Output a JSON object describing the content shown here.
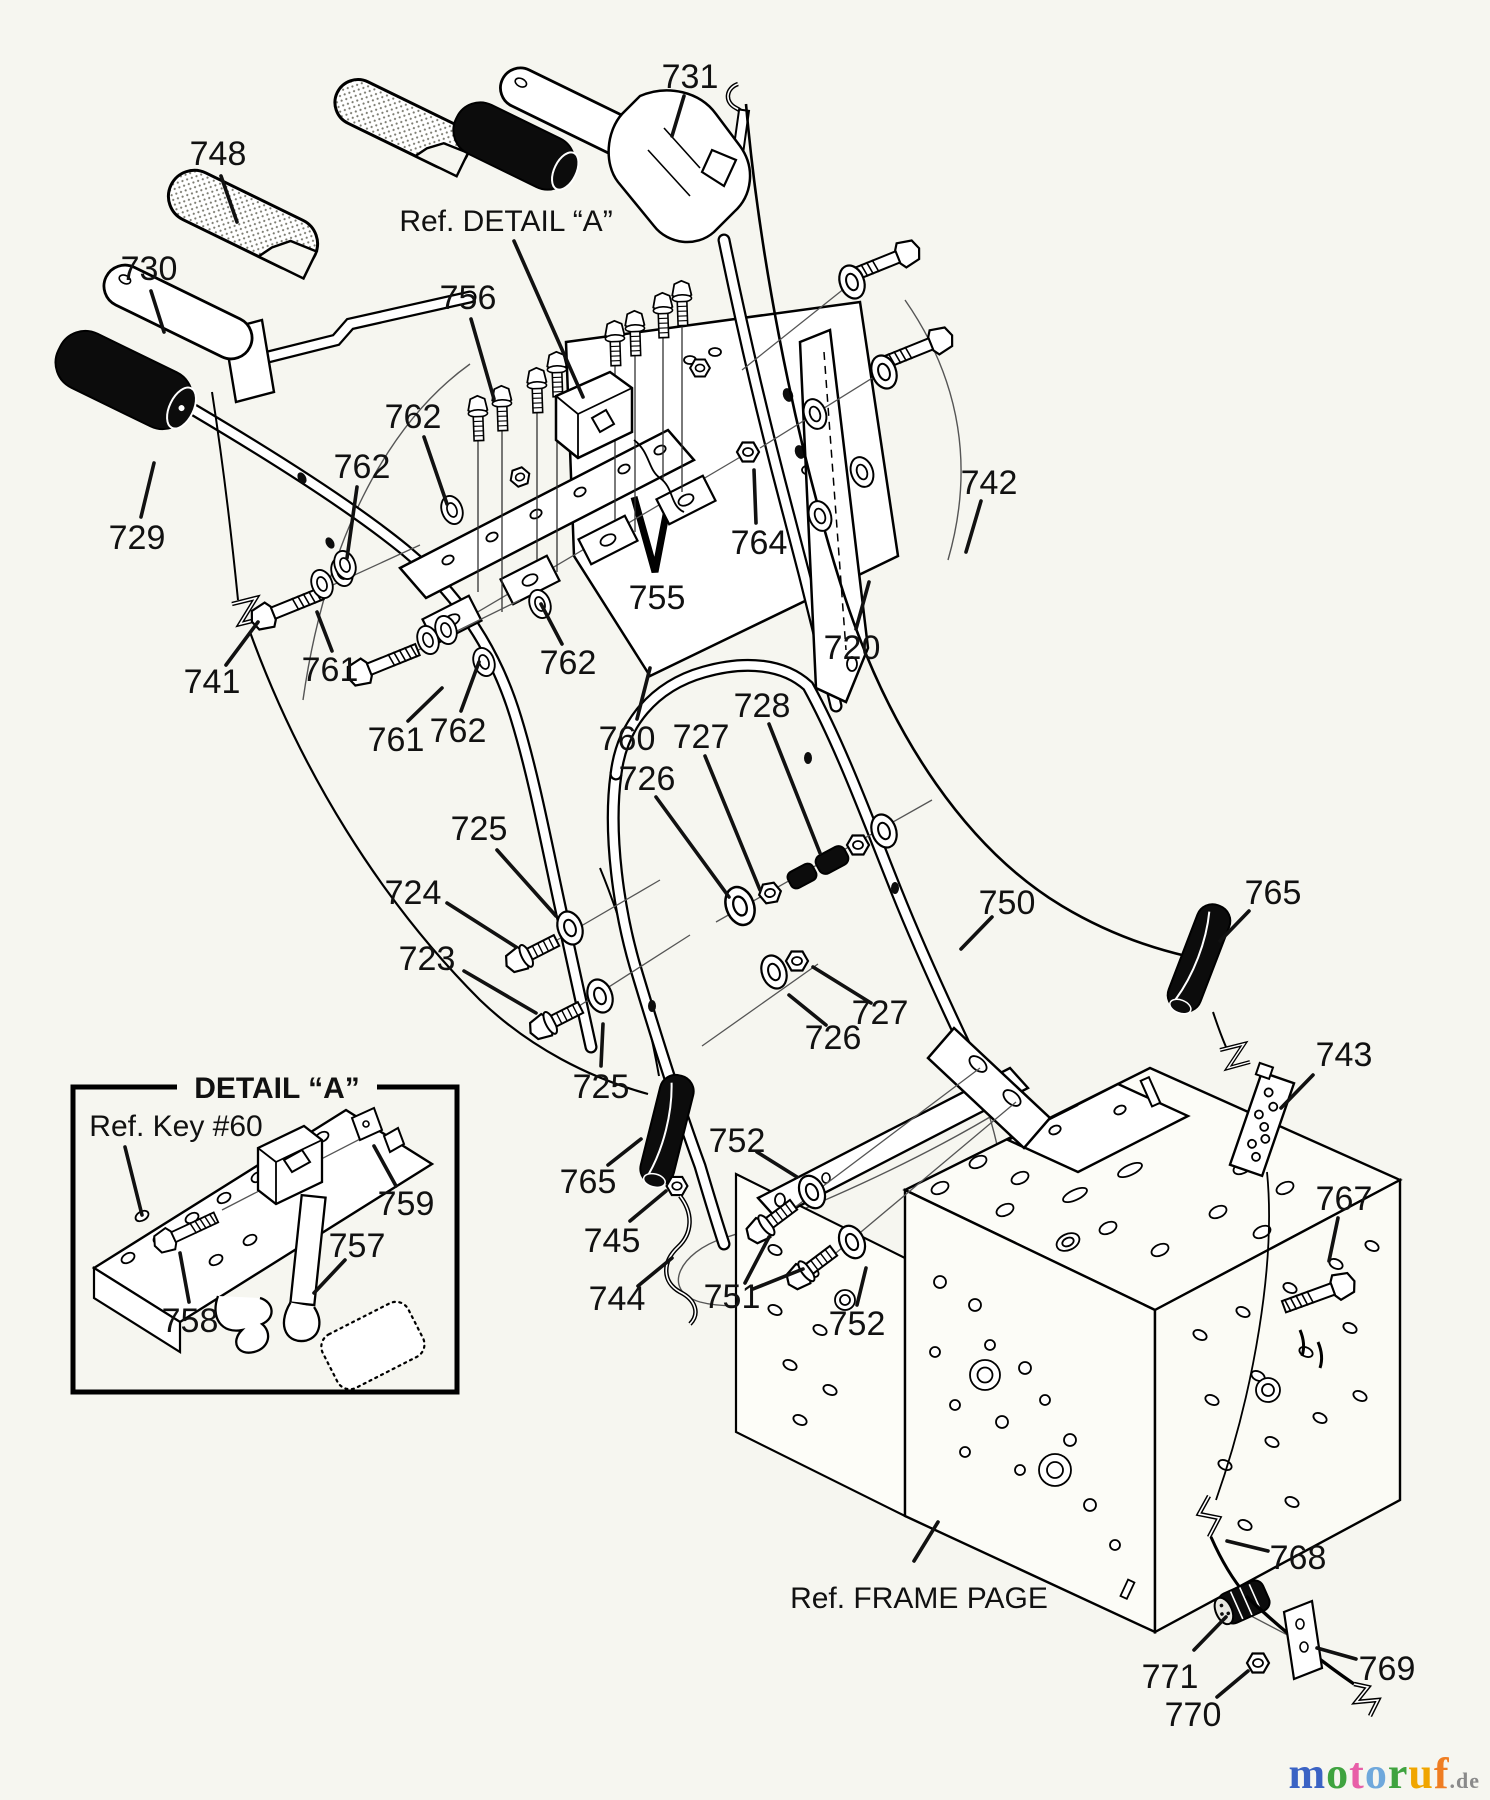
{
  "diagram": {
    "title": "Snow thrower handle assembly exploded parts diagram",
    "background": "#f6f6f0",
    "line_color": "#111111"
  },
  "labels": [
    {
      "text": "731",
      "kind": "number",
      "x": 690,
      "y": 76,
      "leaders": [
        [
          684,
          96,
          672,
          136
        ]
      ]
    },
    {
      "text": "748",
      "kind": "number",
      "x": 218,
      "y": 153,
      "leaders": [
        [
          221,
          176,
          237,
          222
        ]
      ]
    },
    {
      "text": "730",
      "kind": "number",
      "x": 149,
      "y": 268,
      "leaders": [
        [
          151,
          291,
          164,
          332
        ]
      ]
    },
    {
      "text": "729",
      "kind": "number",
      "x": 137,
      "y": 537,
      "leaders": [
        [
          141,
          517,
          154,
          463
        ]
      ]
    },
    {
      "text": "Ref. DETAIL “A”",
      "kind": "ref",
      "x": 506,
      "y": 219,
      "leaders": [
        [
          514,
          241,
          583,
          397
        ]
      ]
    },
    {
      "text": "756",
      "kind": "number",
      "x": 468,
      "y": 297,
      "leaders": [
        [
          471,
          319,
          494,
          399
        ]
      ]
    },
    {
      "text": "762",
      "kind": "number",
      "x": 413,
      "y": 416,
      "leaders": [
        [
          424,
          437,
          447,
          504
        ]
      ]
    },
    {
      "text": "762",
      "kind": "number",
      "x": 362,
      "y": 466,
      "leaders": [
        [
          357,
          487,
          347,
          558
        ]
      ]
    },
    {
      "text": "761",
      "kind": "number",
      "x": 330,
      "y": 669,
      "leaders": [
        [
          332,
          651,
          317,
          612
        ]
      ]
    },
    {
      "text": "741",
      "kind": "number",
      "x": 212,
      "y": 681,
      "leaders": [
        [
          226,
          665,
          258,
          622
        ]
      ]
    },
    {
      "text": "761",
      "kind": "number",
      "x": 396,
      "y": 739,
      "leaders": [
        [
          408,
          721,
          442,
          688
        ]
      ]
    },
    {
      "text": "762",
      "kind": "number",
      "x": 458,
      "y": 730,
      "leaders": [
        [
          461,
          711,
          479,
          662
        ]
      ]
    },
    {
      "text": "762",
      "kind": "number",
      "x": 568,
      "y": 662,
      "leaders": [
        [
          562,
          644,
          541,
          604
        ]
      ]
    },
    {
      "text": "760",
      "kind": "number",
      "x": 627,
      "y": 738,
      "leaders": [
        [
          637,
          719,
          650,
          668
        ]
      ]
    },
    {
      "text": "755",
      "kind": "number",
      "x": 657,
      "y": 597
    },
    {
      "text": "764",
      "kind": "number",
      "x": 759,
      "y": 542,
      "leaders": [
        [
          756,
          523,
          754,
          470
        ]
      ]
    },
    {
      "text": "720",
      "kind": "number",
      "x": 852,
      "y": 647,
      "leaders": [
        [
          856,
          629,
          869,
          582
        ]
      ]
    },
    {
      "text": "742",
      "kind": "number",
      "x": 989,
      "y": 482,
      "leaders": [
        [
          981,
          501,
          966,
          552
        ]
      ]
    },
    {
      "text": "728",
      "kind": "number",
      "x": 762,
      "y": 705,
      "leaders": [
        [
          769,
          724,
          820,
          853
        ]
      ]
    },
    {
      "text": "727",
      "kind": "number",
      "x": 701,
      "y": 736,
      "leaders": [
        [
          705,
          756,
          760,
          890
        ]
      ]
    },
    {
      "text": "726",
      "kind": "number",
      "x": 647,
      "y": 778,
      "leaders": [
        [
          656,
          797,
          729,
          897
        ]
      ]
    },
    {
      "text": "750",
      "kind": "number",
      "x": 1007,
      "y": 902,
      "leaders": [
        [
          992,
          917,
          961,
          949
        ]
      ]
    },
    {
      "text": "765",
      "kind": "number",
      "x": 1273,
      "y": 892,
      "leaders": [
        [
          1249,
          911,
          1220,
          941
        ]
      ]
    },
    {
      "text": "725",
      "kind": "number",
      "x": 479,
      "y": 828,
      "leaders": [
        [
          497,
          850,
          556,
          916
        ]
      ]
    },
    {
      "text": "724",
      "kind": "number",
      "x": 413,
      "y": 892,
      "leaders": [
        [
          447,
          903,
          516,
          947
        ]
      ]
    },
    {
      "text": "723",
      "kind": "number",
      "x": 427,
      "y": 958,
      "leaders": [
        [
          464,
          971,
          536,
          1013
        ]
      ]
    },
    {
      "text": "725",
      "kind": "number",
      "x": 601,
      "y": 1086,
      "leaders": [
        [
          601,
          1066,
          603,
          1024
        ]
      ]
    },
    {
      "text": "727",
      "kind": "number",
      "x": 880,
      "y": 1012,
      "leaders": [
        [
          871,
          1003,
          813,
          967
        ]
      ]
    },
    {
      "text": "726",
      "kind": "number",
      "x": 833,
      "y": 1037,
      "leaders": [
        [
          826,
          1025,
          789,
          995
        ]
      ]
    },
    {
      "text": "743",
      "kind": "number",
      "x": 1344,
      "y": 1054,
      "leaders": [
        [
          1313,
          1075,
          1281,
          1108
        ]
      ]
    },
    {
      "text": "752",
      "kind": "number",
      "x": 737,
      "y": 1140,
      "leaders": [
        [
          757,
          1152,
          797,
          1177
        ]
      ]
    },
    {
      "text": "765",
      "kind": "number",
      "x": 588,
      "y": 1181,
      "leaders": [
        [
          608,
          1165,
          641,
          1139
        ]
      ]
    },
    {
      "text": "745",
      "kind": "number",
      "x": 612,
      "y": 1240,
      "leaders": [
        [
          630,
          1221,
          666,
          1191
        ]
      ]
    },
    {
      "text": "744",
      "kind": "number",
      "x": 617,
      "y": 1298,
      "leaders": [
        [
          638,
          1286,
          672,
          1258
        ]
      ]
    },
    {
      "text": "751",
      "kind": "number",
      "x": 732,
      "y": 1296,
      "leaders": [
        [
          745,
          1283,
          769,
          1237
        ],
        [
          753,
          1289,
          803,
          1269
        ]
      ]
    },
    {
      "text": "752",
      "kind": "number",
      "x": 857,
      "y": 1323,
      "leaders": [
        [
          857,
          1305,
          866,
          1268
        ]
      ]
    },
    {
      "text": "767",
      "kind": "number",
      "x": 1344,
      "y": 1198,
      "leaders": [
        [
          1338,
          1218,
          1329,
          1261
        ]
      ]
    },
    {
      "text": "Ref. FRAME PAGE",
      "kind": "ref",
      "x": 919,
      "y": 1596,
      "leaders": [
        [
          914,
          1561,
          938,
          1522
        ]
      ]
    },
    {
      "text": "768",
      "kind": "number",
      "x": 1298,
      "y": 1557,
      "leaders": [
        [
          1268,
          1551,
          1227,
          1541
        ]
      ]
    },
    {
      "text": "771",
      "kind": "number",
      "x": 1170,
      "y": 1676,
      "leaders": [
        [
          1194,
          1650,
          1226,
          1617
        ]
      ]
    },
    {
      "text": "770",
      "kind": "number",
      "x": 1193,
      "y": 1714,
      "leaders": [
        [
          1217,
          1697,
          1248,
          1671
        ]
      ]
    },
    {
      "text": "769",
      "kind": "number",
      "x": 1387,
      "y": 1668,
      "leaders": [
        [
          1356,
          1659,
          1317,
          1648
        ]
      ]
    },
    {
      "text": "DETAIL “A”",
      "kind": "title",
      "x": 277,
      "y": 1086
    },
    {
      "text": "Ref. Key #60",
      "kind": "ref",
      "x": 176,
      "y": 1124,
      "leaders": [
        [
          125,
          1147,
          142,
          1215
        ]
      ]
    },
    {
      "text": "759",
      "kind": "number",
      "x": 406,
      "y": 1203,
      "leaders": [
        [
          396,
          1186,
          374,
          1146
        ]
      ]
    },
    {
      "text": "757",
      "kind": "number",
      "x": 357,
      "y": 1245,
      "leaders": [
        [
          345,
          1260,
          314,
          1293
        ]
      ]
    },
    {
      "text": "758",
      "kind": "number",
      "x": 190,
      "y": 1320,
      "leaders": [
        [
          189,
          1302,
          180,
          1253
        ]
      ]
    }
  ],
  "logo": {
    "letters": [
      {
        "ch": "m",
        "color": "#3b63c4"
      },
      {
        "ch": "o",
        "color": "#3fa33f"
      },
      {
        "ch": "t",
        "color": "#e85fa8"
      },
      {
        "ch": "o",
        "color": "#6fa8dc"
      },
      {
        "ch": "r",
        "color": "#3fa33f"
      },
      {
        "ch": "u",
        "color": "#f0a500"
      },
      {
        "ch": "f",
        "color": "#ef7d22"
      }
    ],
    "suffix": ".de"
  }
}
